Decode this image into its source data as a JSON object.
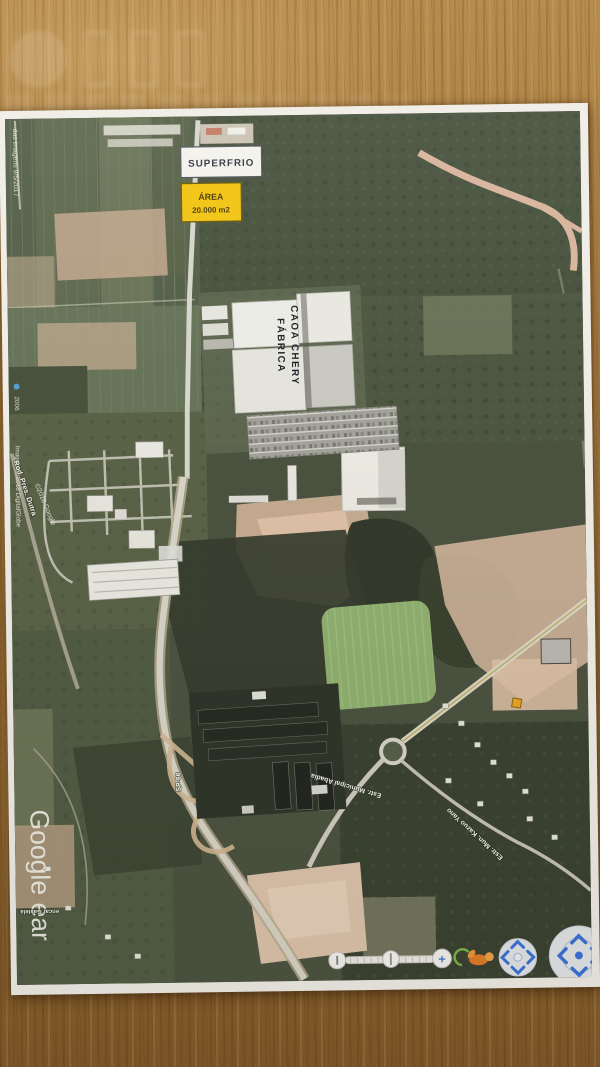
{
  "map_annotations": {
    "superfrio_label": "SUPERFRIO",
    "area_line1": "ÁREA",
    "area_line2": "20.000 m2",
    "factory_line1": "CAOA CHERY",
    "factory_line2": "FÁBRICA"
  },
  "map_credits": {
    "imagery_date": "das imagens 9/5/2017",
    "year_marker": "2006",
    "copyright_digitalglobe": "Imagens ©2018 DigitalGlobe",
    "copyright_google": "©2018 Google",
    "google_watermark": "Google ear"
  },
  "road_labels": {
    "dutra": "Rod. Pres. Dutra",
    "sp66": "SP-66",
    "municipal": "Estr. Municipal Abadia",
    "kazuo_yano": "Estr. Mun. Kazuo Yano",
    "gastela": "encar Gastela"
  },
  "earth_controls": {
    "zoom_in": "+"
  },
  "colors": {
    "wood": "#a87c3f",
    "paper": "#efede6",
    "field_green": "#5a654c",
    "forest_dark": "#363d2f",
    "soil_pink": "#d3b598",
    "road_light": "#d8d5c8",
    "area_box_yellow": "#f2c412",
    "control_blue": "#3b72d8",
    "pegman_orange": "#e07b28"
  }
}
